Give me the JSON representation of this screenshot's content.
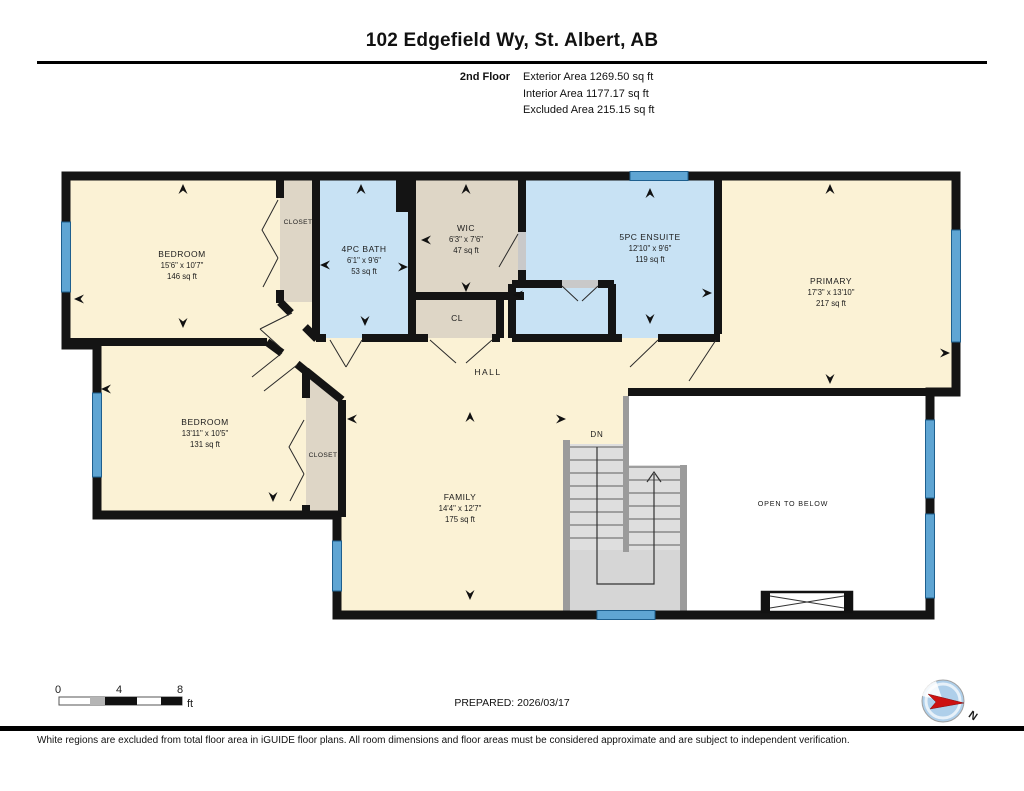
{
  "header": {
    "title": "102 Edgefield Wy, St. Albert, AB",
    "floor_label": "2nd Floor",
    "exterior_area": "Exterior Area 1269.50 sq ft",
    "interior_area": "Interior Area 1177.17 sq ft",
    "excluded_area": "Excluded Area 215.15 sq ft"
  },
  "rooms": {
    "bedroom1_name": "BEDROOM",
    "bedroom1_dims": "15'6\" x 10'7\"",
    "bedroom1_area": "146 sq ft",
    "closet1": "CLOSET",
    "bath_name": "4PC BATH",
    "bath_dims": "6'1\" x 9'6\"",
    "bath_area": "53 sq ft",
    "wic_name": "WIC",
    "wic_dims": "6'3\" x 7'6\"",
    "wic_area": "47 sq ft",
    "cl": "CL",
    "ensuite_name": "5PC ENSUITE",
    "ensuite_dims": "12'10\" x 9'6\"",
    "ensuite_area": "119 sq ft",
    "primary_name": "PRIMARY",
    "primary_dims": "17'3\" x 13'10\"",
    "primary_area": "217 sq ft",
    "bedroom2_name": "BEDROOM",
    "bedroom2_dims": "13'11\" x 10'5\"",
    "bedroom2_area": "131 sq ft",
    "closet2": "CLOSET",
    "hall": "HALL",
    "family_name": "FAMILY",
    "family_dims": "14'4\" x 12'7\"",
    "family_area": "175 sq ft",
    "open_below": "OPEN TO BELOW",
    "stairs_down": "DN"
  },
  "scalebar": {
    "tick0": "0",
    "tick4": "4",
    "tick8": "8",
    "unit": "ft"
  },
  "footer": {
    "prepared": "PREPARED: 2026/03/17",
    "compass_north": "N",
    "disclaimer": "White regions are excluded from total floor area in iGUIDE floor plans. All room dimensions and floor areas must be considered approximate and are subject to independent verification."
  },
  "colors": {
    "room_fill": "#FBF2D5",
    "wet_room_fill": "#C8E2F4",
    "closet_fill": "#DED6C6",
    "wall": "#141414",
    "window": "#5FA5D3",
    "stairs": "#DEDEDE",
    "open_area": "#FFFFFF",
    "compass_red": "#CC1111"
  }
}
